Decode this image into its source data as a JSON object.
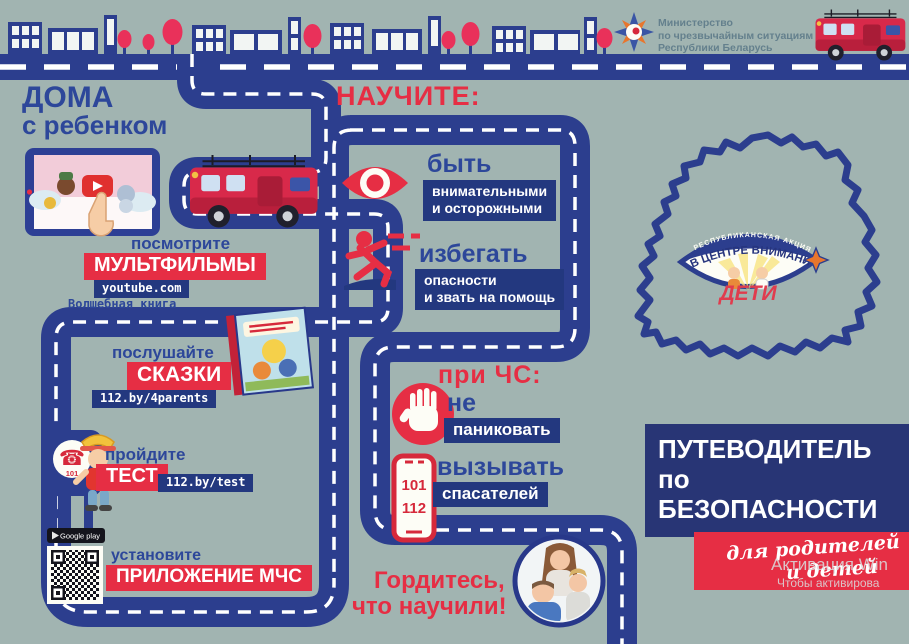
{
  "header": {
    "ministry_lines": [
      "Министерство",
      "по чрезвычайным ситуациям",
      "Республики Беларусь"
    ]
  },
  "home": {
    "title_lines": [
      "ДОМА",
      "с ребенком"
    ],
    "watch": {
      "action": "посмотрите",
      "label": "МУЛЬТФИЛЬМЫ",
      "link": "youtube.com",
      "note": "Волшебная книга"
    },
    "listen": {
      "action": "послушайте",
      "label": "СКАЗКИ",
      "link": "112.by/4parents"
    },
    "test": {
      "action": "пройдите",
      "label": "ТЕСТ",
      "link": "112.by/test",
      "sign_number": "101",
      "sign_phone_glyph": "☎"
    },
    "install": {
      "action": "установите",
      "label": "ПРИЛОЖЕНИЕ МЧС",
      "store": "Google play"
    }
  },
  "teach": {
    "title": "НАУЧИТЕ:",
    "be": {
      "head": "быть",
      "sub1": "внимательными",
      "sub2": "и осторожными"
    },
    "avoid": {
      "head": "избегать",
      "sub1": "опасности",
      "sub2": "и звать на помощь"
    },
    "emergency_title": "при ЧС:",
    "no_panic": {
      "head": "не",
      "sub1": "паниковать"
    },
    "call": {
      "head": "вызывать",
      "sub1": "спасателей",
      "numbers": [
        "101",
        "112"
      ]
    },
    "proud_lines": [
      "Гордитесь,",
      "что научили!"
    ]
  },
  "campaign": {
    "arc_small": "РЕСПУБЛИКАНСКАЯ АКЦИЯ",
    "arc_main": "В ЦЕНТРЕ ВНИМАНИЯ",
    "label": "ДЕТИ"
  },
  "guide": {
    "title_lines": [
      "ПУТЕВОДИТЕЛЬ",
      "по",
      "БЕЗОПАСНОСТИ"
    ],
    "ribbon_lines": [
      "для родителей",
      "и детей"
    ]
  },
  "watermark": {
    "line1": "Активация Win",
    "line2": "Чтобы активирова"
  },
  "colors": {
    "background": "#a1b4b1",
    "road_blue": "#2c3e8e",
    "accent_red": "#e62e44",
    "chip_navy": "#23387f",
    "panel_navy": "#283575"
  }
}
